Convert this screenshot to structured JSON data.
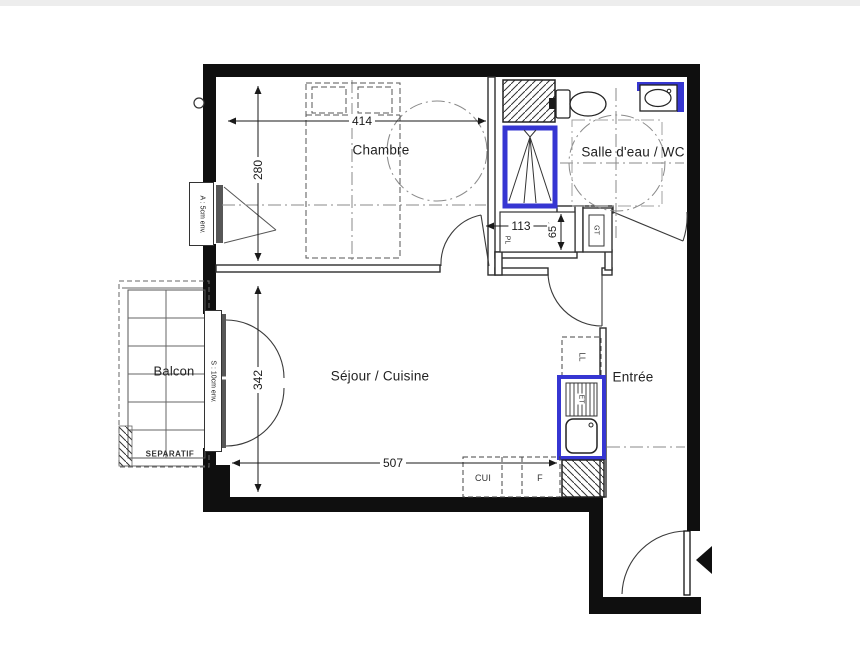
{
  "rooms": {
    "chambre": "Chambre",
    "salle_eau": "Salle d'eau / WC",
    "sejour": "Séjour / Cuisine",
    "entree": "Entrée",
    "balcon": "Balcon"
  },
  "dimensions": {
    "chambre_width": "414",
    "chambre_depth": "280",
    "sejour_depth": "342",
    "closet_width": "113",
    "closet_depth": "65",
    "sejour_width": "507"
  },
  "labels": {
    "closet": "PL",
    "technical_duct": "GT",
    "washing_machine": "LL",
    "sink_drainer": "ET",
    "cooker": "CUI",
    "fridge": "F",
    "separator": "SEPARATIF",
    "window_note": "A : 5cm env.",
    "balcony_door_note": "S : 10cm env."
  },
  "colors": {
    "fixture_blue": "#3636d2",
    "wall_black": "#0f0f0f"
  }
}
